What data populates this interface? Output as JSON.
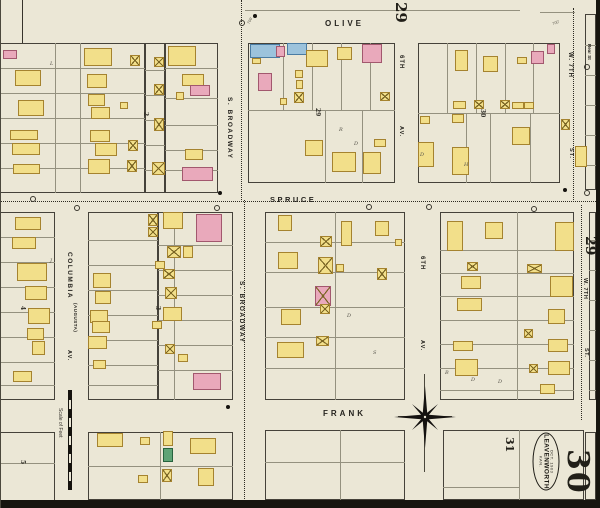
{
  "meta": {
    "map_type": "fire-insurance-map",
    "city": "LEAVENWORTH",
    "state": "KAN.",
    "date": "OCT. 1903",
    "sheet_number": "30"
  },
  "sheet_labels": {
    "top_adjacent": "29",
    "right_adjacent": "29",
    "south_block": "31",
    "current_large": "30"
  },
  "stamp": {
    "date": "OCT. 1903",
    "city": "LEAVENWORTH",
    "state": "KAN."
  },
  "scalebar": {
    "label": "Scale of Feet"
  },
  "legend": {
    "frame_building": "#f2df8a",
    "brick_building": "#e9a9bb",
    "stone_building": "#9cc3dc",
    "special_building": "#5fa476"
  },
  "street_labels": [
    {
      "t": "OLIVE",
      "x": 325,
      "y": 19,
      "v": 0,
      "s": 8,
      "ls": 3
    },
    {
      "t": "SPRUCE",
      "x": 270,
      "y": 195,
      "v": 0,
      "s": 7.5,
      "ls": 2.5
    },
    {
      "t": "FRANK",
      "x": 323,
      "y": 409,
      "v": 0,
      "s": 8,
      "ls": 3
    },
    {
      "t": "S. BROADWAY",
      "x": 226,
      "y": 97,
      "v": 1,
      "s": 6.5,
      "ls": 1.5
    },
    {
      "t": "S. BROADWAY",
      "x": 238,
      "y": 281,
      "v": 1,
      "s": 6.5,
      "ls": 1.5
    },
    {
      "t": "COLUMBIA",
      "x": 66,
      "y": 252,
      "v": 1,
      "s": 6.5,
      "ls": 1.5
    },
    {
      "t": "(AUGUSTA)",
      "x": 73,
      "y": 303,
      "v": 1,
      "s": 4.5,
      "ls": 0.5
    },
    {
      "t": "AV.",
      "x": 66,
      "y": 350,
      "v": 1,
      "s": 5.5,
      "ls": 1
    },
    {
      "t": "6TH",
      "x": 398,
      "y": 55,
      "v": 1,
      "s": 6,
      "ls": 1
    },
    {
      "t": "AV.",
      "x": 398,
      "y": 126,
      "v": 1,
      "s": 5.5,
      "ls": 1
    },
    {
      "t": "6TH",
      "x": 419,
      "y": 256,
      "v": 1,
      "s": 6,
      "ls": 1
    },
    {
      "t": "AV.",
      "x": 419,
      "y": 340,
      "v": 1,
      "s": 5.5,
      "ls": 1
    },
    {
      "t": "W. 7TH",
      "x": 567,
      "y": 52,
      "v": 1,
      "s": 6,
      "ls": 1
    },
    {
      "t": "ST.",
      "x": 568,
      "y": 148,
      "v": 1,
      "s": 5.5,
      "ls": 1
    },
    {
      "t": "W. 7TH",
      "x": 582,
      "y": 278,
      "v": 1,
      "s": 5.5,
      "ls": 0.5
    },
    {
      "t": "ST.",
      "x": 583,
      "y": 348,
      "v": 1,
      "s": 5.5,
      "ls": 0.5
    },
    {
      "t": "Rear St",
      "x": 587,
      "y": 44,
      "v": 1,
      "s": 4.5,
      "ls": 0
    }
  ],
  "block_numbers": [
    {
      "t": "29",
      "x": 314,
      "y": 108
    },
    {
      "t": "30",
      "x": 479,
      "y": 109
    },
    {
      "t": "2",
      "x": 142,
      "y": 112
    },
    {
      "t": "3",
      "x": 154,
      "y": 306
    },
    {
      "t": "4",
      "x": 19,
      "y": 306
    },
    {
      "t": "5",
      "x": 19,
      "y": 460
    }
  ],
  "letters": [
    {
      "t": "L",
      "x": 50,
      "y": 61
    },
    {
      "t": "R",
      "x": 339,
      "y": 127
    },
    {
      "t": "D",
      "x": 354,
      "y": 141
    },
    {
      "t": "D",
      "x": 420,
      "y": 152
    },
    {
      "t": "H",
      "x": 464,
      "y": 162
    },
    {
      "t": "J",
      "x": 50,
      "y": 258
    },
    {
      "t": "D",
      "x": 347,
      "y": 313
    },
    {
      "t": "S",
      "x": 373,
      "y": 350
    },
    {
      "t": "B",
      "x": 445,
      "y": 370
    },
    {
      "t": "D",
      "x": 471,
      "y": 377
    },
    {
      "t": "D",
      "x": 498,
      "y": 379
    }
  ],
  "annotations": [
    {
      "t": "700'",
      "x": 246,
      "y": 18,
      "rot": -62
    },
    {
      "t": "700'",
      "x": 552,
      "y": 20,
      "rot": -20
    }
  ],
  "blocks": [
    [
      -12,
      43,
      157,
      150
    ],
    [
      145,
      43,
      20,
      150
    ],
    [
      165,
      43,
      53,
      150
    ],
    [
      248,
      43,
      147,
      140
    ],
    [
      418,
      43,
      142,
      140
    ],
    [
      585,
      14,
      11,
      176
    ],
    [
      -12,
      212,
      67,
      188
    ],
    [
      88,
      212,
      70,
      188
    ],
    [
      158,
      212,
      75,
      188
    ],
    [
      265,
      212,
      140,
      188
    ],
    [
      440,
      212,
      134,
      188
    ],
    [
      589,
      212,
      7,
      188
    ],
    [
      -12,
      432,
      67,
      76
    ],
    [
      88,
      432,
      145,
      68
    ],
    [
      265,
      430,
      140,
      70
    ],
    [
      443,
      430,
      141,
      70
    ],
    [
      585,
      432,
      11,
      68
    ]
  ],
  "lot_lines": [
    [
      0,
      68,
      145,
      68
    ],
    [
      0,
      93,
      145,
      93
    ],
    [
      0,
      118,
      145,
      118
    ],
    [
      0,
      143,
      145,
      143
    ],
    [
      0,
      168,
      145,
      168
    ],
    [
      55,
      43,
      55,
      193
    ],
    [
      80,
      43,
      80,
      193
    ],
    [
      145,
      70,
      165,
      70
    ],
    [
      145,
      95,
      165,
      95
    ],
    [
      145,
      120,
      165,
      120
    ],
    [
      145,
      145,
      165,
      145
    ],
    [
      145,
      170,
      165,
      170
    ],
    [
      165,
      68,
      218,
      68
    ],
    [
      165,
      98,
      218,
      98
    ],
    [
      165,
      125,
      218,
      125
    ],
    [
      165,
      150,
      218,
      150
    ],
    [
      165,
      170,
      218,
      170
    ],
    [
      248,
      110,
      395,
      110
    ],
    [
      283,
      43,
      283,
      110
    ],
    [
      312,
      43,
      312,
      110
    ],
    [
      341,
      43,
      341,
      110
    ],
    [
      370,
      43,
      370,
      110
    ],
    [
      325,
      110,
      325,
      183
    ],
    [
      362,
      110,
      362,
      183
    ],
    [
      418,
      113,
      560,
      113
    ],
    [
      447,
      43,
      447,
      113
    ],
    [
      476,
      43,
      476,
      113
    ],
    [
      505,
      43,
      505,
      113
    ],
    [
      533,
      43,
      533,
      113
    ],
    [
      466,
      113,
      466,
      183
    ],
    [
      490,
      113,
      490,
      183
    ],
    [
      530,
      113,
      530,
      183
    ],
    [
      585,
      45,
      596,
      45
    ],
    [
      585,
      75,
      596,
      75
    ],
    [
      585,
      105,
      596,
      105
    ],
    [
      585,
      135,
      596,
      135
    ],
    [
      585,
      165,
      596,
      165
    ],
    [
      245,
      10,
      520,
      10
    ],
    [
      540,
      12,
      575,
      12
    ],
    [
      0,
      237,
      55,
      237
    ],
    [
      0,
      262,
      55,
      262
    ],
    [
      0,
      287,
      55,
      287
    ],
    [
      0,
      312,
      55,
      312
    ],
    [
      0,
      337,
      55,
      337
    ],
    [
      0,
      362,
      55,
      362
    ],
    [
      0,
      385,
      55,
      385
    ],
    [
      88,
      240,
      158,
      240
    ],
    [
      88,
      265,
      158,
      265
    ],
    [
      88,
      290,
      158,
      290
    ],
    [
      88,
      315,
      158,
      315
    ],
    [
      88,
      340,
      158,
      340
    ],
    [
      88,
      365,
      158,
      365
    ],
    [
      88,
      385,
      158,
      385
    ],
    [
      174,
      212,
      174,
      400
    ],
    [
      158,
      245,
      233,
      245
    ],
    [
      158,
      270,
      233,
      270
    ],
    [
      158,
      295,
      233,
      295
    ],
    [
      158,
      320,
      233,
      320
    ],
    [
      158,
      345,
      233,
      345
    ],
    [
      158,
      370,
      233,
      370
    ],
    [
      335,
      212,
      335,
      400
    ],
    [
      265,
      242,
      405,
      242
    ],
    [
      265,
      272,
      405,
      272
    ],
    [
      265,
      307,
      405,
      307
    ],
    [
      265,
      337,
      405,
      337
    ],
    [
      265,
      368,
      405,
      368
    ],
    [
      517,
      212,
      517,
      400
    ],
    [
      440,
      250,
      574,
      250
    ],
    [
      440,
      273,
      574,
      273
    ],
    [
      440,
      296,
      574,
      296
    ],
    [
      440,
      320,
      574,
      320
    ],
    [
      440,
      344,
      574,
      344
    ],
    [
      440,
      368,
      574,
      368
    ],
    [
      440,
      390,
      574,
      390
    ],
    [
      589,
      240,
      596,
      240
    ],
    [
      589,
      270,
      596,
      270
    ],
    [
      589,
      300,
      596,
      300
    ],
    [
      589,
      330,
      596,
      330
    ],
    [
      589,
      360,
      596,
      360
    ],
    [
      589,
      390,
      596,
      390
    ],
    [
      0,
      463,
      55,
      463
    ],
    [
      160,
      432,
      160,
      500
    ],
    [
      88,
      466,
      233,
      466
    ],
    [
      340,
      430,
      340,
      500
    ],
    [
      265,
      462,
      405,
      462
    ],
    [
      519,
      430,
      519,
      500
    ],
    [
      443,
      487,
      519,
      487
    ]
  ],
  "street_dotted_lines": [
    [
      241,
      0,
      241,
      200
    ],
    [
      244,
      200,
      244,
      505
    ],
    [
      573,
      8,
      573,
      200
    ],
    [
      581,
      205,
      581,
      420
    ],
    [
      0,
      201,
      596,
      201
    ]
  ],
  "buildings": [
    [
      3,
      50,
      14,
      9,
      "p",
      0
    ],
    [
      15,
      70,
      26,
      16,
      "y",
      0
    ],
    [
      18,
      100,
      26,
      16,
      "y",
      0
    ],
    [
      10,
      130,
      28,
      10,
      "y",
      0
    ],
    [
      12,
      143,
      28,
      12,
      "y",
      0
    ],
    [
      13,
      164,
      27,
      10,
      "y",
      0
    ],
    [
      84,
      48,
      28,
      18,
      "y",
      0
    ],
    [
      87,
      74,
      20,
      14,
      "y",
      0
    ],
    [
      88,
      94,
      17,
      12,
      "y",
      0
    ],
    [
      91,
      107,
      19,
      12,
      "y",
      0
    ],
    [
      120,
      102,
      8,
      7,
      "y",
      0
    ],
    [
      90,
      130,
      20,
      12,
      "y",
      0
    ],
    [
      95,
      143,
      22,
      13,
      "y",
      0
    ],
    [
      88,
      159,
      22,
      15,
      "y",
      0
    ],
    [
      128,
      140,
      10,
      11,
      "y",
      1
    ],
    [
      127,
      160,
      10,
      12,
      "y",
      1
    ],
    [
      130,
      55,
      10,
      11,
      "y",
      1
    ],
    [
      154,
      57,
      10,
      10,
      "y",
      1
    ],
    [
      154,
      84,
      10,
      11,
      "y",
      1
    ],
    [
      154,
      118,
      10,
      13,
      "y",
      1
    ],
    [
      152,
      162,
      13,
      13,
      "y",
      1
    ],
    [
      168,
      46,
      28,
      20,
      "y",
      0
    ],
    [
      182,
      74,
      22,
      12,
      "y",
      0
    ],
    [
      190,
      85,
      20,
      11,
      "p",
      0
    ],
    [
      176,
      92,
      8,
      8,
      "y",
      0
    ],
    [
      185,
      149,
      18,
      11,
      "y",
      0
    ],
    [
      182,
      167,
      31,
      14,
      "p",
      0
    ],
    [
      250,
      44,
      30,
      14,
      "b",
      0
    ],
    [
      276,
      46,
      9,
      11,
      "p",
      0
    ],
    [
      252,
      58,
      9,
      6,
      "y",
      0
    ],
    [
      287,
      43,
      20,
      12,
      "b",
      0
    ],
    [
      306,
      50,
      22,
      17,
      "y",
      0
    ],
    [
      337,
      47,
      15,
      13,
      "y",
      0
    ],
    [
      362,
      44,
      20,
      19,
      "p",
      0
    ],
    [
      258,
      73,
      14,
      18,
      "p",
      0
    ],
    [
      295,
      70,
      8,
      8,
      "y",
      0
    ],
    [
      296,
      80,
      7,
      9,
      "y",
      0
    ],
    [
      294,
      92,
      10,
      11,
      "y",
      1
    ],
    [
      280,
      98,
      7,
      7,
      "y",
      0
    ],
    [
      380,
      92,
      10,
      9,
      "y",
      1
    ],
    [
      305,
      140,
      18,
      16,
      "y",
      0
    ],
    [
      332,
      152,
      24,
      20,
      "y",
      0
    ],
    [
      363,
      152,
      18,
      22,
      "y",
      0
    ],
    [
      374,
      139,
      12,
      8,
      "y",
      0
    ],
    [
      455,
      50,
      13,
      21,
      "y",
      0
    ],
    [
      483,
      56,
      15,
      16,
      "y",
      0
    ],
    [
      517,
      57,
      10,
      7,
      "y",
      0
    ],
    [
      531,
      51,
      13,
      13,
      "p",
      0
    ],
    [
      547,
      44,
      8,
      10,
      "p",
      0
    ],
    [
      453,
      101,
      13,
      8,
      "y",
      0
    ],
    [
      474,
      100,
      10,
      9,
      "y",
      1
    ],
    [
      500,
      100,
      10,
      9,
      "y",
      1
    ],
    [
      512,
      102,
      12,
      7,
      "y",
      0
    ],
    [
      524,
      102,
      10,
      7,
      "y",
      0
    ],
    [
      420,
      116,
      10,
      8,
      "y",
      0
    ],
    [
      452,
      114,
      12,
      9,
      "y",
      0
    ],
    [
      512,
      127,
      18,
      18,
      "y",
      0
    ],
    [
      418,
      142,
      16,
      25,
      "y",
      0
    ],
    [
      452,
      147,
      17,
      28,
      "y",
      0
    ],
    [
      561,
      119,
      9,
      11,
      "y",
      1
    ],
    [
      575,
      146,
      12,
      21,
      "y",
      0
    ],
    [
      15,
      217,
      26,
      13,
      "y",
      0
    ],
    [
      12,
      237,
      24,
      12,
      "y",
      0
    ],
    [
      17,
      263,
      30,
      18,
      "y",
      0
    ],
    [
      25,
      286,
      22,
      14,
      "y",
      0
    ],
    [
      28,
      308,
      22,
      16,
      "y",
      0
    ],
    [
      27,
      328,
      17,
      12,
      "y",
      0
    ],
    [
      32,
      341,
      13,
      14,
      "y",
      0
    ],
    [
      13,
      371,
      19,
      11,
      "y",
      0
    ],
    [
      93,
      273,
      18,
      15,
      "y",
      0
    ],
    [
      95,
      291,
      16,
      13,
      "y",
      0
    ],
    [
      90,
      310,
      18,
      13,
      "y",
      0
    ],
    [
      92,
      321,
      18,
      12,
      "y",
      0
    ],
    [
      88,
      336,
      19,
      13,
      "y",
      0
    ],
    [
      93,
      360,
      13,
      9,
      "y",
      0
    ],
    [
      148,
      214,
      10,
      12,
      "y",
      1
    ],
    [
      148,
      227,
      10,
      10,
      "y",
      1
    ],
    [
      163,
      212,
      20,
      17,
      "y",
      0
    ],
    [
      196,
      214,
      26,
      28,
      "p",
      0
    ],
    [
      167,
      246,
      14,
      12,
      "y",
      1
    ],
    [
      183,
      246,
      10,
      12,
      "y",
      0
    ],
    [
      155,
      261,
      10,
      8,
      "y",
      0
    ],
    [
      163,
      269,
      12,
      10,
      "y",
      1
    ],
    [
      165,
      287,
      12,
      12,
      "y",
      1
    ],
    [
      163,
      307,
      19,
      14,
      "y",
      0
    ],
    [
      152,
      321,
      10,
      8,
      "y",
      0
    ],
    [
      165,
      344,
      10,
      10,
      "y",
      1
    ],
    [
      178,
      354,
      10,
      8,
      "y",
      0
    ],
    [
      193,
      373,
      28,
      17,
      "p",
      0
    ],
    [
      278,
      215,
      14,
      16,
      "y",
      0
    ],
    [
      320,
      236,
      12,
      11,
      "y",
      1
    ],
    [
      341,
      221,
      11,
      25,
      "y",
      0
    ],
    [
      375,
      221,
      14,
      15,
      "y",
      0
    ],
    [
      395,
      239,
      7,
      7,
      "y",
      0
    ],
    [
      278,
      252,
      20,
      17,
      "y",
      0
    ],
    [
      318,
      257,
      15,
      17,
      "y",
      1
    ],
    [
      336,
      264,
      8,
      8,
      "y",
      0
    ],
    [
      377,
      268,
      10,
      12,
      "y",
      1
    ],
    [
      315,
      286,
      16,
      20,
      "p",
      1
    ],
    [
      281,
      309,
      20,
      16,
      "y",
      0
    ],
    [
      320,
      304,
      10,
      10,
      "y",
      1
    ],
    [
      316,
      336,
      13,
      10,
      "y",
      1
    ],
    [
      277,
      342,
      27,
      16,
      "y",
      0
    ],
    [
      447,
      221,
      16,
      30,
      "y",
      0
    ],
    [
      485,
      222,
      18,
      17,
      "y",
      0
    ],
    [
      555,
      222,
      19,
      29,
      "y",
      0
    ],
    [
      467,
      262,
      11,
      9,
      "y",
      1
    ],
    [
      461,
      276,
      20,
      13,
      "y",
      0
    ],
    [
      527,
      264,
      15,
      9,
      "y",
      1
    ],
    [
      457,
      298,
      25,
      13,
      "y",
      0
    ],
    [
      550,
      276,
      23,
      21,
      "y",
      0
    ],
    [
      548,
      309,
      17,
      15,
      "y",
      0
    ],
    [
      524,
      329,
      9,
      9,
      "y",
      1
    ],
    [
      453,
      341,
      20,
      10,
      "y",
      0
    ],
    [
      548,
      339,
      20,
      13,
      "y",
      0
    ],
    [
      455,
      359,
      23,
      17,
      "y",
      0
    ],
    [
      529,
      364,
      9,
      9,
      "y",
      1
    ],
    [
      548,
      361,
      22,
      14,
      "y",
      0
    ],
    [
      540,
      384,
      15,
      10,
      "y",
      0
    ],
    [
      97,
      433,
      26,
      14,
      "y",
      0
    ],
    [
      140,
      437,
      10,
      8,
      "y",
      0
    ],
    [
      163,
      431,
      10,
      15,
      "y",
      0
    ],
    [
      163,
      448,
      10,
      14,
      "g",
      0
    ],
    [
      162,
      469,
      10,
      13,
      "y",
      1
    ],
    [
      138,
      475,
      10,
      8,
      "y",
      0
    ],
    [
      190,
      438,
      26,
      16,
      "y",
      0
    ],
    [
      198,
      468,
      16,
      18,
      "y",
      0
    ]
  ],
  "dots": [
    [
      253,
      14
    ],
    [
      218,
      191
    ],
    [
      226,
      405
    ],
    [
      563,
      188
    ]
  ],
  "circles": [
    [
      30,
      196
    ],
    [
      214,
      205
    ],
    [
      366,
      204
    ],
    [
      426,
      204
    ],
    [
      531,
      206
    ],
    [
      584,
      190
    ],
    [
      239,
      20
    ],
    [
      584,
      64
    ],
    [
      74,
      205
    ]
  ]
}
